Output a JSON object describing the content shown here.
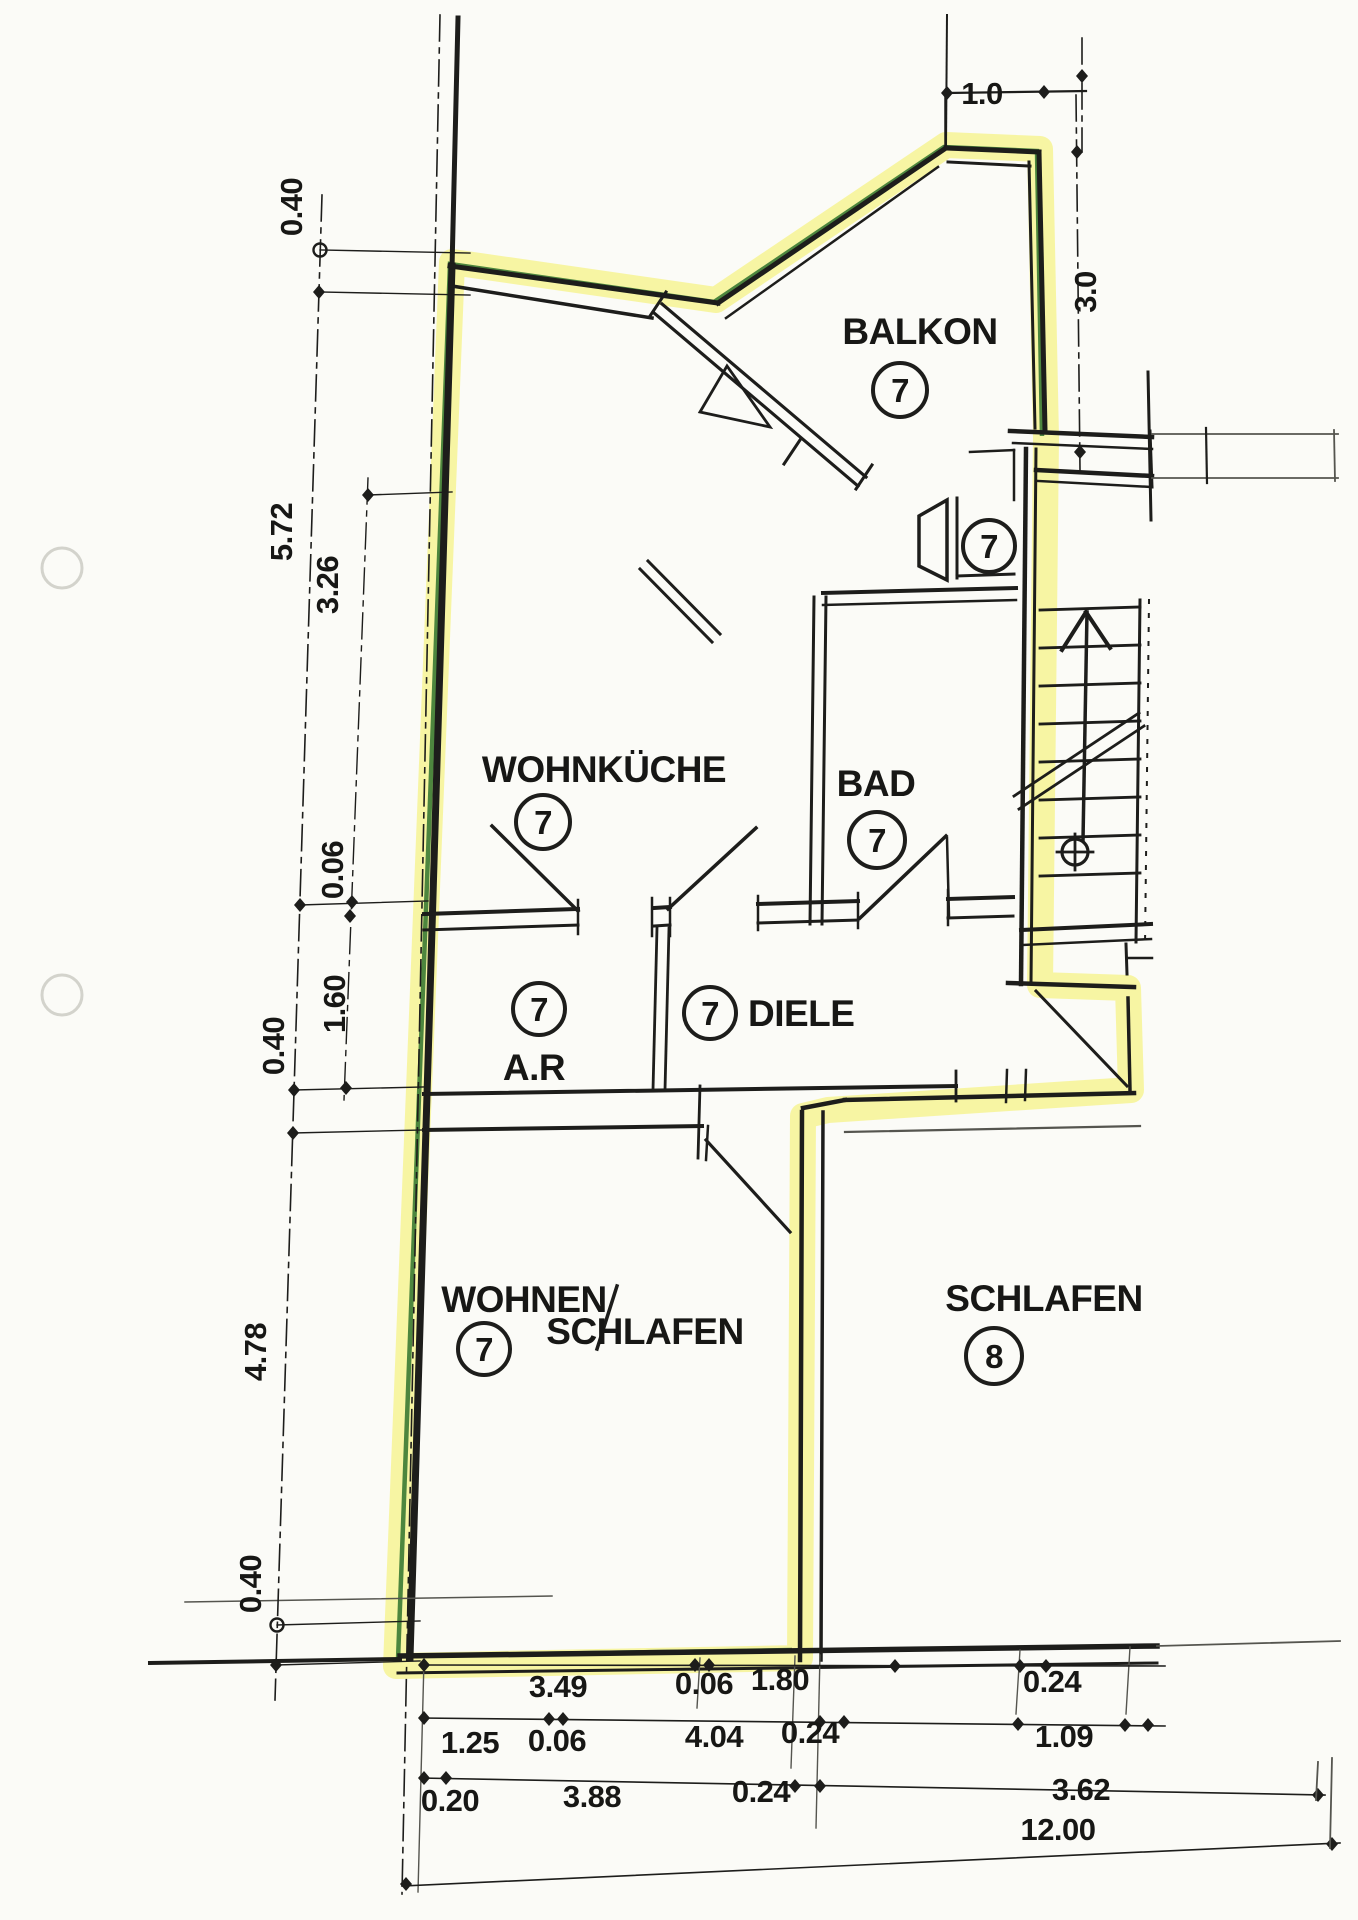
{
  "plan": {
    "title_note": "floor plan with unit 7 highlighted",
    "rooms": [
      {
        "name": "BALKON",
        "unit": "7"
      },
      {
        "name": "WOHNKÜCHE",
        "unit": "7"
      },
      {
        "name": "BAD",
        "unit": "7"
      },
      {
        "name": "DIELE",
        "unit": "7"
      },
      {
        "name": "A.R",
        "unit": "7"
      },
      {
        "name": "WOHNEN",
        "name2": "SCHLAFEN",
        "unit": "7"
      },
      {
        "name": "SCHLAFEN",
        "unit": "8"
      }
    ],
    "entry_unit": "7",
    "dims": {
      "top": "1.0",
      "right": "3.0",
      "left_outer": [
        "0.40",
        "5.72",
        "0.40",
        "4.78",
        "0.40"
      ],
      "left_inner": [
        "3.26",
        "0.06",
        "1.60"
      ],
      "row1": [
        "3.49",
        "0.06",
        "1.80",
        "0.24"
      ],
      "row2": [
        "1.25",
        "0.06",
        "4.04",
        "0.24",
        "1.09"
      ],
      "row3": [
        "0.20",
        "3.88",
        "0.24",
        "3.62"
      ],
      "total": "12.00"
    },
    "colors": {
      "highlight": "#f3ef6e",
      "marker_green": "#3a7a33",
      "ink": "#1d1d1b",
      "paper": "#fbfbf7"
    }
  }
}
